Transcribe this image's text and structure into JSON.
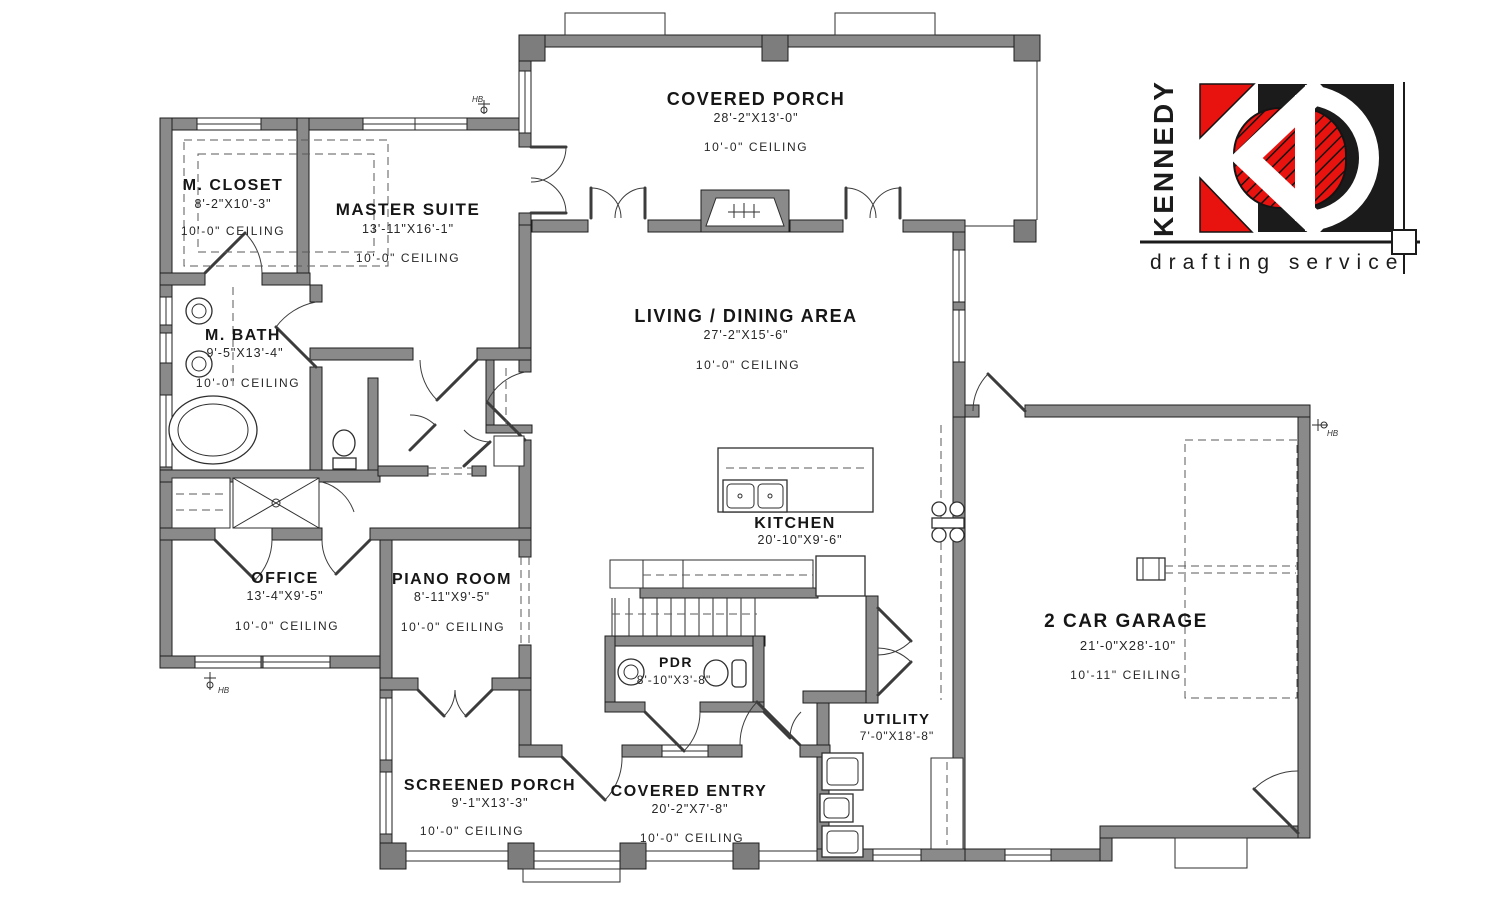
{
  "logo": {
    "brand": "KENNEDY",
    "tagline": "drafting service",
    "red": "#e8120f",
    "black": "#1b1b1b"
  },
  "symbols": {
    "hose_bibb": "HB"
  },
  "colors": {
    "wall_fill": "#8a8a8a",
    "ink": "#1d1d1d",
    "background": "#ffffff"
  },
  "rooms": {
    "m_closet": {
      "name": "M. CLOSET",
      "dims": "8'-2\"X10'-3\"",
      "ceiling": "10'-0\" CEILING"
    },
    "master_suite": {
      "name": "MASTER SUITE",
      "dims": "13'-11\"X16'-1\"",
      "ceiling": "10'-0\" CEILING"
    },
    "m_bath": {
      "name": "M. BATH",
      "dims": "9'-5\"X13'-4\"",
      "ceiling": "10'-0\" CEILING"
    },
    "covered_porch": {
      "name": "COVERED PORCH",
      "dims": "28'-2\"X13'-0\"",
      "ceiling": "10'-0\" CEILING"
    },
    "living_dining": {
      "name": "LIVING / DINING AREA",
      "dims": "27'-2\"X15'-6\"",
      "ceiling": "10'-0\" CEILING"
    },
    "kitchen": {
      "name": "KITCHEN",
      "dims": "20'-10\"X9'-6\""
    },
    "office": {
      "name": "OFFICE",
      "dims": "13'-4\"X9'-5\"",
      "ceiling": "10'-0\" CEILING"
    },
    "piano_room": {
      "name": "PIANO ROOM",
      "dims": "8'-11\"X9'-5\"",
      "ceiling": "10'-0\" CEILING"
    },
    "pdr": {
      "name": "PDR",
      "dims": "8'-10\"X3'-8\""
    },
    "utility": {
      "name": "UTILITY",
      "dims": "7'-0\"X18'-8\""
    },
    "garage": {
      "name": "2 CAR GARAGE",
      "dims": "21'-0\"X28'-10\"",
      "ceiling": "10'-11\" CEILING"
    },
    "screened_porch": {
      "name": "SCREENED PORCH",
      "dims": "9'-1\"X13'-3\"",
      "ceiling": "10'-0\" CEILING"
    },
    "covered_entry": {
      "name": "COVERED ENTRY",
      "dims": "20'-2\"X7'-8\"",
      "ceiling": "10'-0\" CEILING"
    }
  }
}
